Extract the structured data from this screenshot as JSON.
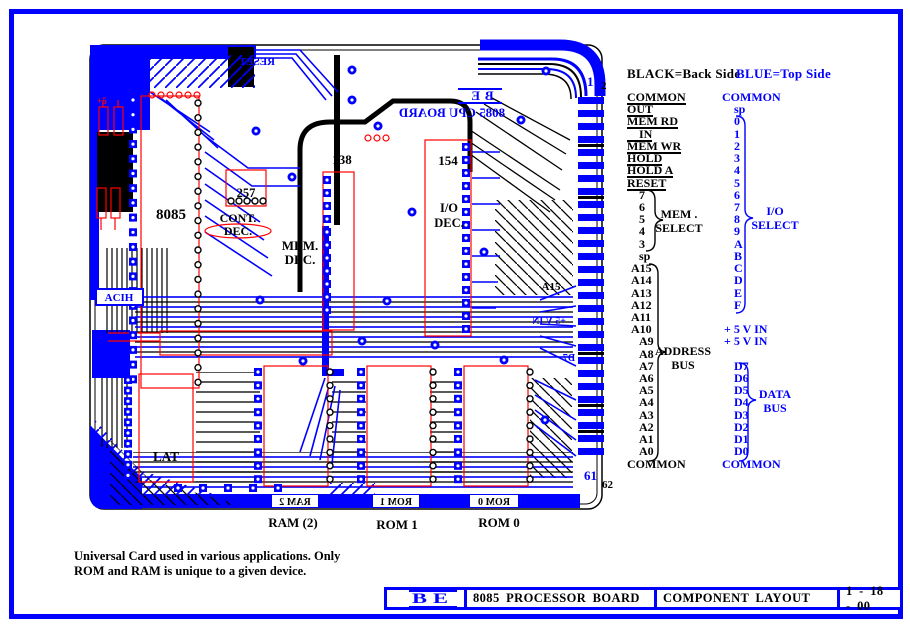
{
  "colors": {
    "top_side": "#0000FF",
    "back_side": "#000000",
    "component_outline": "#FF0000",
    "page_border": "#0000FF"
  },
  "legend": {
    "black": "BLACK=Back Side",
    "blue": "BLUE=Top Side"
  },
  "connector": {
    "pin_top_blue": "1",
    "pin_top_black": "2",
    "pin_bottom_blue": "61",
    "pin_bottom_black": "62",
    "black_rows": [
      {
        "t": "COMMON",
        "bar": true
      },
      {
        "t": "OUT",
        "bar": true
      },
      {
        "t": "MEM RD",
        "bar": true
      },
      {
        "t": "IN",
        "bar": true
      },
      {
        "t": "MEM WR",
        "bar": true
      },
      {
        "t": "HOLD",
        "bar": true
      },
      {
        "t": "HOLD A",
        "bar": true
      },
      {
        "t": "RESET",
        "bar": true
      },
      {
        "t": "7"
      },
      {
        "t": "6"
      },
      {
        "t": "5"
      },
      {
        "t": "4"
      },
      {
        "t": "3"
      },
      {
        "t": "sp"
      },
      {
        "t": "A15"
      },
      {
        "t": "A14"
      },
      {
        "t": "A13"
      },
      {
        "t": "A12"
      },
      {
        "t": "A11"
      },
      {
        "t": "A10"
      },
      {
        "t": "A9"
      },
      {
        "t": "A8"
      },
      {
        "t": "A7"
      },
      {
        "t": "A6"
      },
      {
        "t": "A5"
      },
      {
        "t": "A4"
      },
      {
        "t": "A3"
      },
      {
        "t": "A2"
      },
      {
        "t": "A1"
      },
      {
        "t": "A0"
      },
      {
        "t": "COMMON"
      }
    ],
    "blue_rows": [
      "COMMON",
      "sp",
      "0",
      "1",
      "2",
      "3",
      "4",
      "5",
      "6",
      "7",
      "8",
      "9",
      "A",
      "B",
      "C",
      "D",
      "E",
      "F",
      "",
      "+ 5 V IN",
      "+ 5 V IN",
      "",
      "D7",
      "D6",
      "D5",
      "D4",
      "D3",
      "D2",
      "D1",
      "D0",
      "COMMON"
    ],
    "groups": {
      "mem_select_1": "MEM .",
      "mem_select_2": "SELECT",
      "io_select_1": "I/O",
      "io_select_2": "SELECT",
      "address_bus_1": "ADDRESS",
      "address_bus_2": "BUS",
      "data_bus_1": "DATA",
      "data_bus_2": "BUS"
    }
  },
  "board": {
    "chips": {
      "cpu": "8085",
      "latch": "LAT",
      "mux": "257",
      "decoder": "138",
      "io_decoder": "154",
      "io_dec_1": "I/O",
      "io_dec_2": "DEC.",
      "mem_dec_1": "MEM.",
      "mem_dec_2": "DEC.",
      "cont_dec_1": "CONT.",
      "cont_dec_2": "DEC."
    },
    "silkscreen": {
      "board_name": "8085 CPU BOARD",
      "logo": "BE",
      "reset": "RESET",
      "a15": "A15",
      "plus5": "+5",
      "plus5vin": "+5 V IN",
      "d7": "D7",
      "left_box": "ACIH",
      "ram_box": "RAM 2",
      "rom1_box": "ROM 1",
      "rom0_box": "ROM 0"
    },
    "bottom_labels": {
      "ram": "RAM (2)",
      "rom1": "ROM 1",
      "rom0": "ROM 0"
    }
  },
  "note": {
    "line1": "Universal Card used in various applications.  Only",
    "line2": "ROM and RAM is unique to a given device."
  },
  "title_block": {
    "logo": "BE",
    "board": "8085 PROCESSOR BOARD",
    "sheet": "COMPONENT LAYOUT",
    "date": "1 - 18 - 00"
  }
}
